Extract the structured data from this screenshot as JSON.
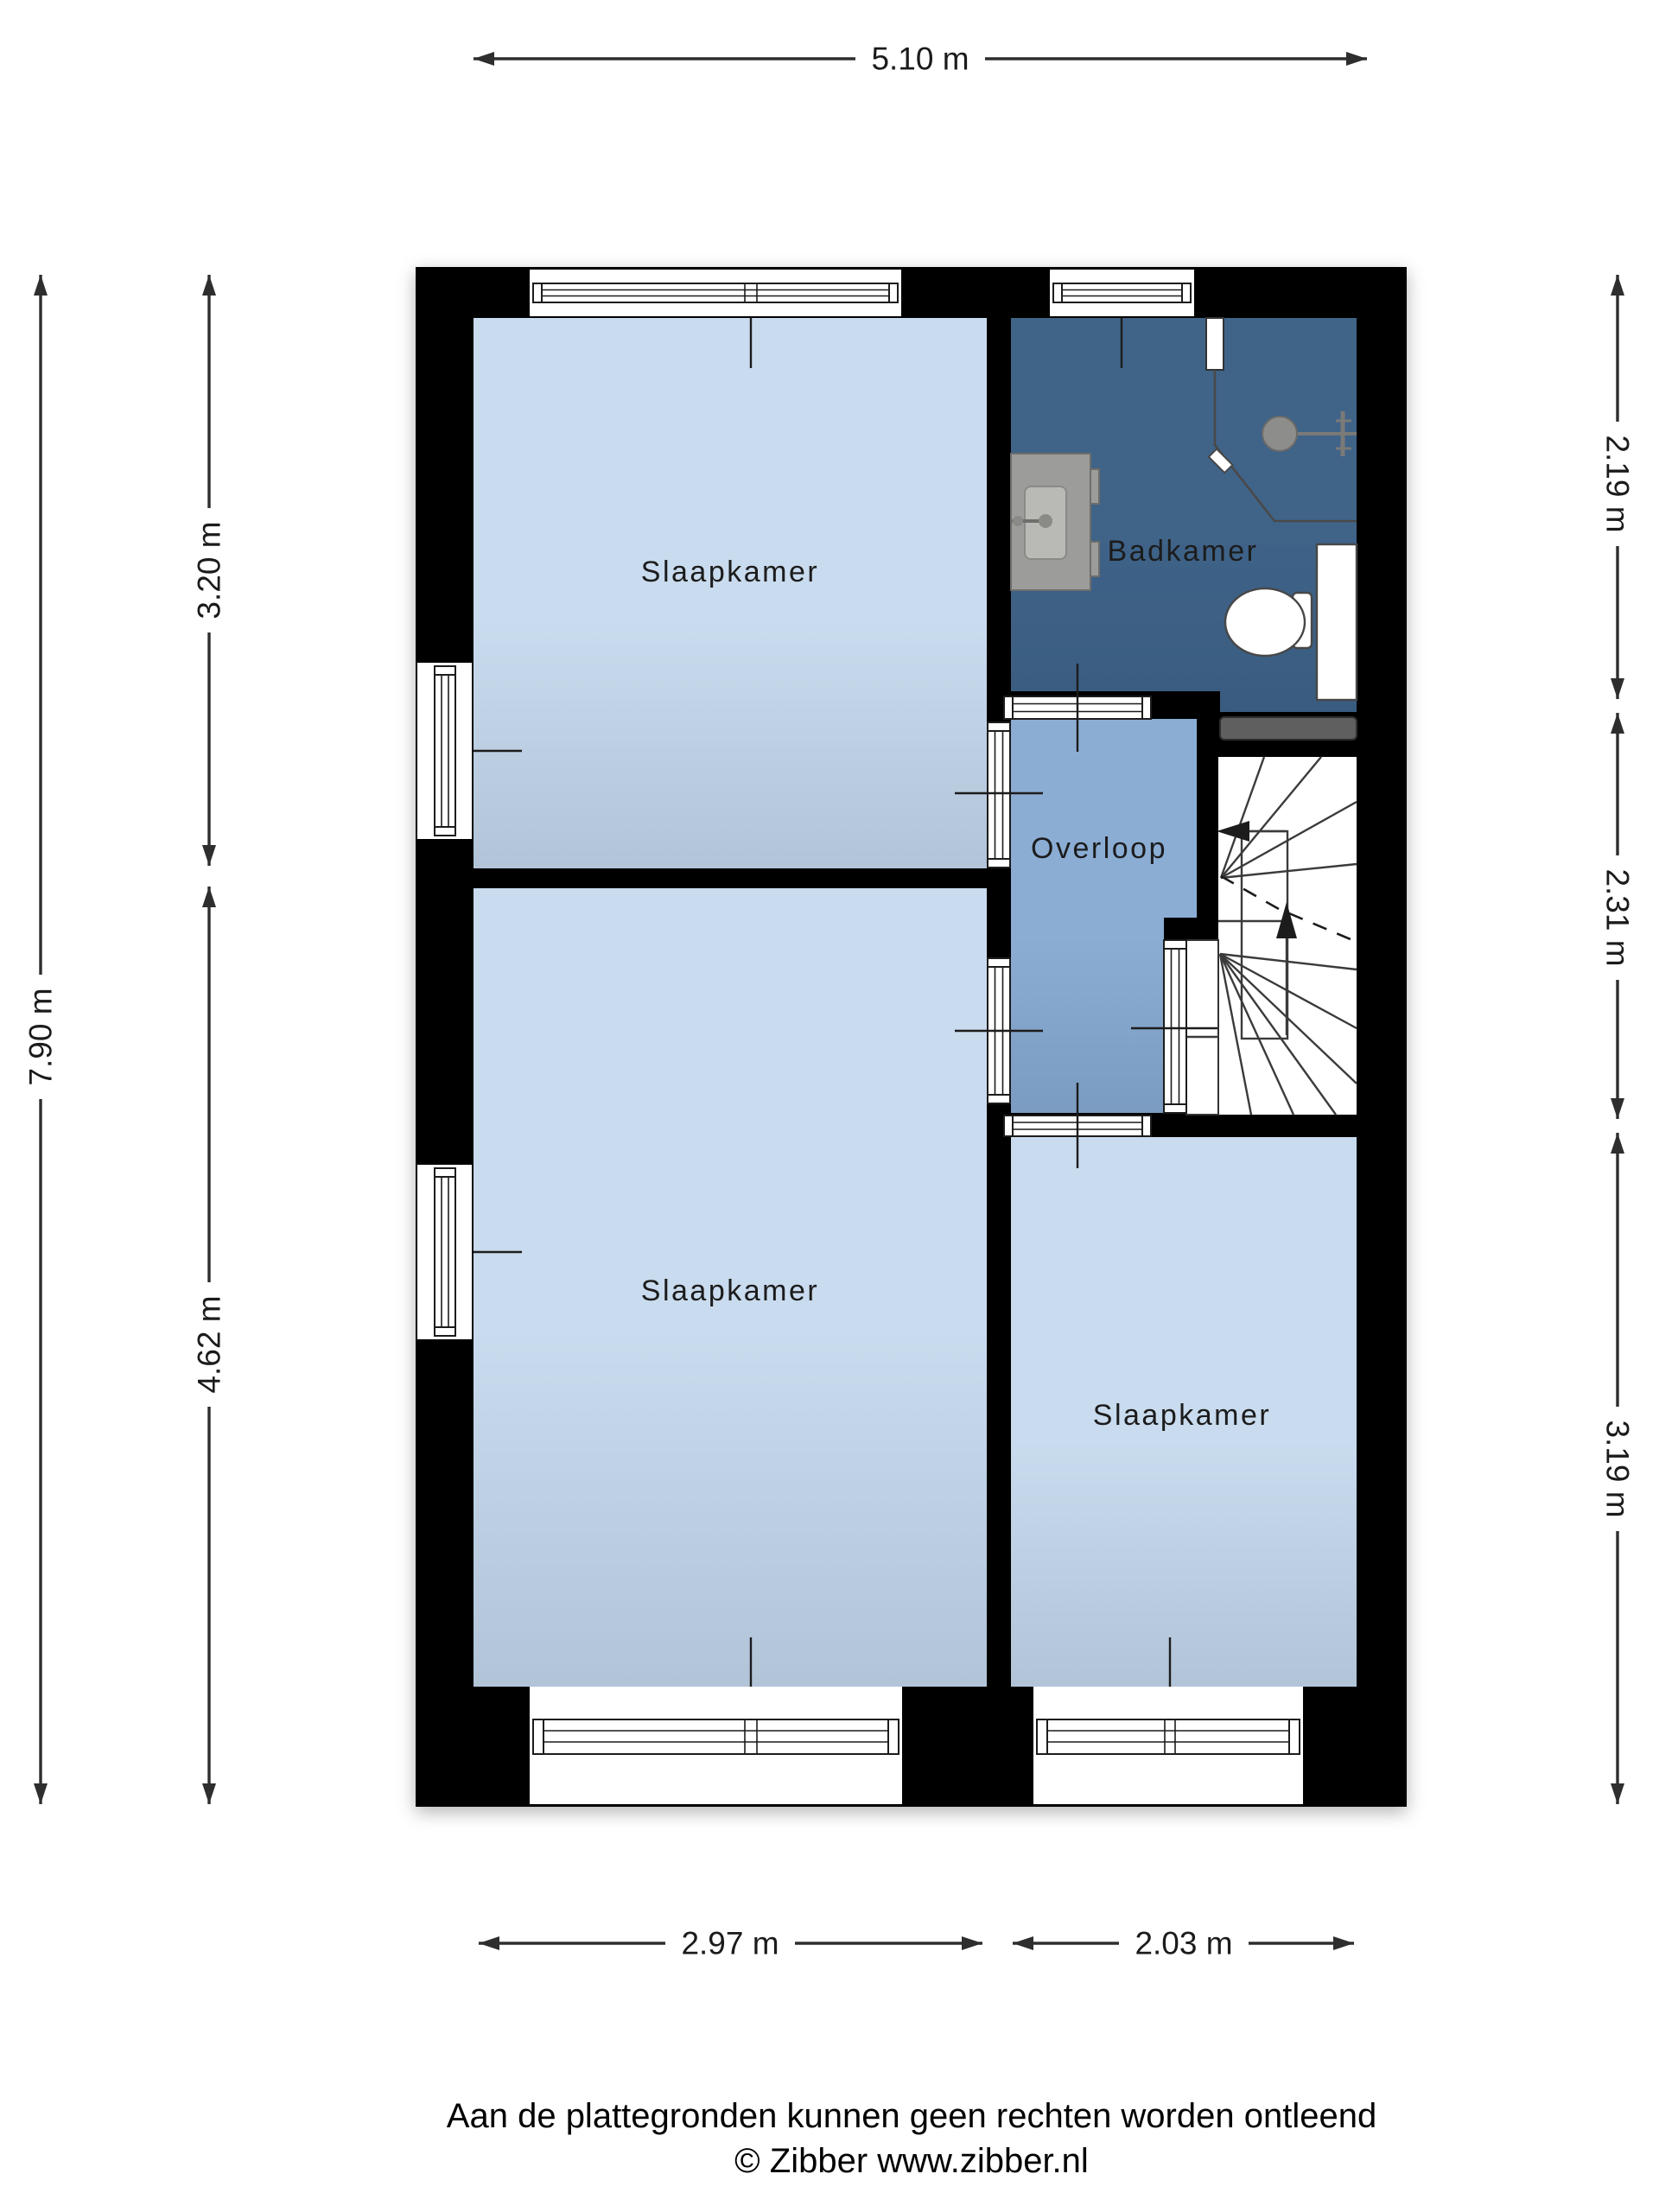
{
  "plan": {
    "rooms": {
      "bedroom_top": "Slaapkamer",
      "bedroom_left": "Slaapkamer",
      "bedroom_right": "Slaapkamer",
      "bathroom": "Badkamer",
      "landing": "Overloop"
    },
    "dimensions": {
      "total_width": "5.10 m",
      "total_height": "7.90 m",
      "left_upper": "3.20 m",
      "left_lower": "4.62 m",
      "right_upper": "2.19 m",
      "right_middle": "2.31 m",
      "right_lower": "3.19 m",
      "bottom_left": "2.97 m",
      "bottom_right": "2.03 m"
    },
    "footer": {
      "disclaimer": "Aan de plattegronden kunnen geen rechten worden ontleend",
      "copyright": "© Zibber www.zibber.nl"
    },
    "colors": {
      "bedroom": "#c9dbee",
      "landing": "#8badd4",
      "bathroom": "#3f6388",
      "wall": "#000000",
      "shelf": "#5e5e5e",
      "fixture": "#9c9c9a",
      "line": "#2e2e2e",
      "label": "#1b1b1b"
    }
  }
}
